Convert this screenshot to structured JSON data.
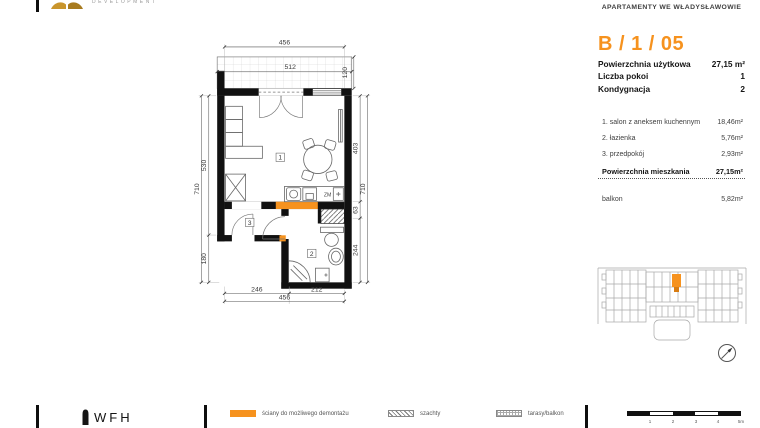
{
  "colors": {
    "accent": "#F6921E",
    "wall": "#111111"
  },
  "brand": {
    "development": "DEVELOPMENT",
    "footer_logo": "WFH"
  },
  "header": {
    "project": "APARTAMENTY WE WŁADYSŁAWOWIE"
  },
  "unit": {
    "code": "B / 1 / 05",
    "summary": [
      {
        "label": "Powierzchnia użytkowa",
        "value": "27,15 m²"
      },
      {
        "label": "Liczba pokoi",
        "value": "1"
      },
      {
        "label": "Kondygnacja",
        "value": "2"
      }
    ],
    "rooms": [
      {
        "label": "1. salon z aneksem kuchennym",
        "value": "18,46m²"
      },
      {
        "label": "2. łazienka",
        "value": "5,76m²"
      },
      {
        "label": "3. przedpokój",
        "value": "2,93m²"
      }
    ],
    "total": {
      "label": "Powierzchnia mieszkania",
      "value": "27,15m²"
    },
    "balcony": {
      "label": "balkon",
      "value": "5,82m²"
    }
  },
  "plan": {
    "dims": {
      "top_total": "456",
      "balcony_width": "512",
      "balcony_depth": "120",
      "left_total": "710",
      "left_a": "530",
      "left_b": "180",
      "right_a": "403",
      "right_b": "63",
      "right_c": "244",
      "right_total": "710",
      "bottom_a": "246",
      "bottom_b": "212",
      "bottom_total": "456"
    },
    "labels": {
      "salon": "1",
      "bathroom": "2",
      "hall": "3",
      "dishwasher": "ZM"
    }
  },
  "legend": {
    "items": [
      {
        "key": "demolishable-walls",
        "label": "ściany do możliwego demontażu"
      },
      {
        "key": "shafts",
        "label": "szachty"
      },
      {
        "key": "terraces",
        "label": "tarasy/balkon"
      }
    ],
    "scale_ticks": [
      "1",
      "2",
      "3",
      "4",
      "5m"
    ]
  }
}
